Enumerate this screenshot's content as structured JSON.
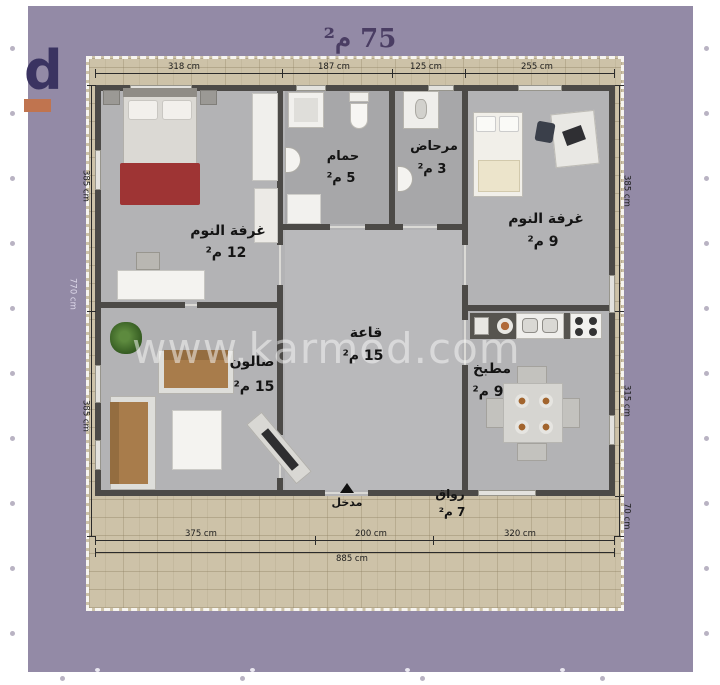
{
  "title": "75 م²",
  "watermark": "www.karmod.com",
  "logo": {
    "letter": "d"
  },
  "rooms": {
    "bedroom1": {
      "name": "غرفة النوم",
      "area": "12 م²"
    },
    "bathroom": {
      "name": "حمام",
      "area": "5 م²"
    },
    "wc": {
      "name": "مرحاض",
      "area": "3 م²"
    },
    "bedroom2": {
      "name": "غرفة النوم",
      "area": "9 م²"
    },
    "hall": {
      "name": "قاعة",
      "area": "15 م²"
    },
    "salon": {
      "name": "صالون",
      "area": "15 م²"
    },
    "kitchen": {
      "name": "مطبخ",
      "area": "9 م²"
    },
    "porch": {
      "name": "رواق",
      "area": "7 م²"
    },
    "entrance": {
      "name": "مدخل"
    }
  },
  "dimensions": {
    "top": [
      "318 cm",
      "187 cm",
      "125 cm",
      "255 cm"
    ],
    "bottom_segments": [
      "375 cm",
      "200 cm",
      "320 cm"
    ],
    "bottom_total": "885 cm",
    "left_segments": [
      "385 cm",
      "385 cm"
    ],
    "left_total": "770 cm",
    "right_segments": [
      "385 cm",
      "315 cm",
      "70 cm"
    ]
  },
  "colors": {
    "background_purple": "#938aa6",
    "margin_white": "#ffffff",
    "brick": "#cdc2a8",
    "wall": "#4c4a47",
    "floor": "#b3b3b5",
    "logo_orange": "#c0744f",
    "title_text": "#4a3d63",
    "blanket_red": "#9e3434",
    "sofa_brown": "#a87c4b"
  }
}
